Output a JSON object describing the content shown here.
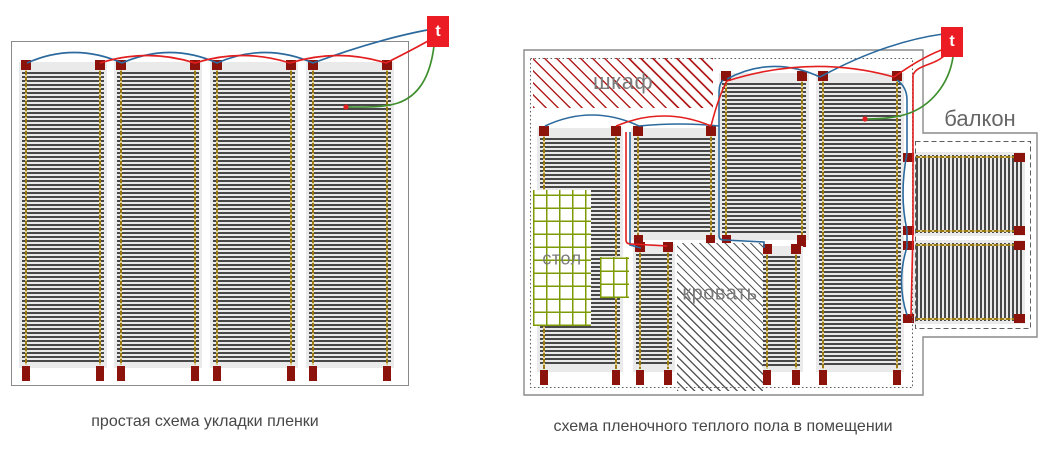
{
  "left": {
    "caption": "простая схема укладки пленки",
    "thermostat": "t"
  },
  "right": {
    "caption": "схема пленочного теплого пола в помещении",
    "thermostat": "t",
    "labels": {
      "wardrobe": "шкаф",
      "table": "стол",
      "bed": "кровать",
      "balcony": "балкон"
    }
  },
  "colors": {
    "wire_blue": "#2c6a9e",
    "wire_red": "#e31e1e",
    "wire_green": "#3f8f2f",
    "sensor_dot": "#e31e1e",
    "terminal": "#8c120c",
    "thermostat_bg": "#ec1c24",
    "film_stripe": "#484848",
    "busbar": "#9c7c10",
    "wardrobe_hatch": "#b32020",
    "bed_hatch": "#5a5a5a",
    "table_grid": "#7d9b04",
    "outline": "#8a8a8a"
  }
}
